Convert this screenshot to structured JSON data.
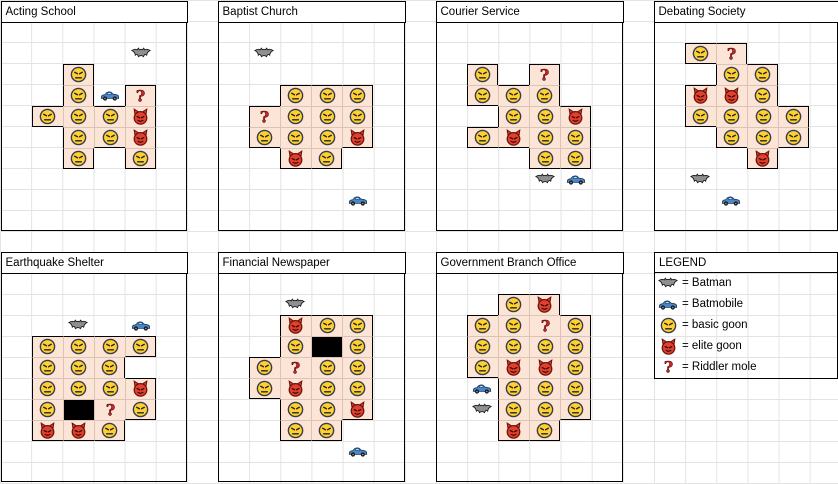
{
  "colors": {
    "shape_fill": "#fce4d6",
    "shape_inner_border": "#d9c4b5",
    "shape_outline": "#000000",
    "black_cell": "#000000",
    "gridline": "#e3e3e3",
    "title_bg": "#ffffff",
    "goon_yellow": "#ffd02e",
    "goon_outline": "#343c50",
    "face_lines": "#1d2430",
    "elite_red": "#e2402e",
    "elite_outline": "#6d1209",
    "riddler_red": "#c5252b",
    "riddler_outline": "#470000",
    "batman_gray": "#8f8f8f",
    "batman_outline": "#1c1c1c",
    "batmobile_blue": "#4a86c8",
    "batmobile_window": "#b8e4f7",
    "batmobile_outline": "#14365c"
  },
  "boards": [
    {
      "title": "Acting School",
      "px": 0,
      "py": 0,
      "cells": [
        [
          2,
          3,
          "basic"
        ],
        [
          2,
          4,
          "basic"
        ],
        [
          4,
          4,
          "riddler"
        ],
        [
          1,
          5,
          "basic"
        ],
        [
          2,
          5,
          "basic"
        ],
        [
          3,
          5,
          "basic"
        ],
        [
          4,
          5,
          "elite"
        ],
        [
          2,
          6,
          "basic"
        ],
        [
          3,
          6,
          "basic"
        ],
        [
          4,
          6,
          "elite"
        ],
        [
          2,
          7,
          "basic"
        ],
        [
          4,
          7,
          "basic"
        ]
      ],
      "icons": [
        [
          4,
          2,
          "batman"
        ],
        [
          3,
          4,
          "batmobile"
        ]
      ]
    },
    {
      "title": "Baptist Church",
      "px": 1,
      "py": 0,
      "cells": [
        [
          2,
          4,
          "basic"
        ],
        [
          3,
          4,
          "basic"
        ],
        [
          4,
          4,
          "basic"
        ],
        [
          1,
          5,
          "riddler"
        ],
        [
          2,
          5,
          "basic"
        ],
        [
          3,
          5,
          "basic"
        ],
        [
          4,
          5,
          "basic"
        ],
        [
          1,
          6,
          "basic"
        ],
        [
          2,
          6,
          "basic"
        ],
        [
          3,
          6,
          "basic"
        ],
        [
          4,
          6,
          "elite"
        ],
        [
          2,
          7,
          "elite"
        ],
        [
          3,
          7,
          "basic"
        ]
      ],
      "icons": [
        [
          1,
          2,
          "batman"
        ],
        [
          4,
          9,
          "batmobile"
        ]
      ]
    },
    {
      "title": "Courier Service",
      "px": 2,
      "py": 0,
      "cells": [
        [
          1,
          3,
          "basic"
        ],
        [
          3,
          3,
          "riddler"
        ],
        [
          1,
          4,
          "basic"
        ],
        [
          2,
          4,
          "basic"
        ],
        [
          3,
          4,
          "basic"
        ],
        [
          2,
          5,
          "basic"
        ],
        [
          3,
          5,
          "basic"
        ],
        [
          4,
          5,
          "elite"
        ],
        [
          1,
          6,
          "basic"
        ],
        [
          2,
          6,
          "elite"
        ],
        [
          3,
          6,
          "basic"
        ],
        [
          4,
          6,
          "basic"
        ],
        [
          3,
          7,
          "basic"
        ],
        [
          4,
          7,
          "basic"
        ]
      ],
      "icons": [
        [
          3,
          8,
          "batman"
        ],
        [
          4,
          8,
          "batmobile"
        ]
      ]
    },
    {
      "title": "Debating Society",
      "px": 3,
      "py": 0,
      "cells": [
        [
          1,
          2,
          "basic"
        ],
        [
          2,
          2,
          "riddler"
        ],
        [
          2,
          3,
          "basic"
        ],
        [
          3,
          3,
          "basic"
        ],
        [
          1,
          4,
          "elite"
        ],
        [
          2,
          4,
          "elite"
        ],
        [
          3,
          4,
          "basic"
        ],
        [
          1,
          5,
          "basic"
        ],
        [
          2,
          5,
          "basic"
        ],
        [
          3,
          5,
          "basic"
        ],
        [
          4,
          5,
          "basic"
        ],
        [
          2,
          6,
          "basic"
        ],
        [
          3,
          6,
          "basic"
        ],
        [
          4,
          6,
          "basic"
        ],
        [
          3,
          7,
          "elite"
        ]
      ],
      "icons": [
        [
          1,
          8,
          "batman"
        ],
        [
          2,
          9,
          "batmobile"
        ]
      ]
    },
    {
      "title": "Earthquake Shelter",
      "px": 0,
      "py": 1,
      "cells": [
        [
          1,
          4,
          "basic"
        ],
        [
          2,
          4,
          "basic"
        ],
        [
          3,
          4,
          "basic"
        ],
        [
          4,
          4,
          "basic"
        ],
        [
          1,
          5,
          "basic"
        ],
        [
          2,
          5,
          "basic"
        ],
        [
          3,
          5,
          "basic"
        ],
        [
          1,
          6,
          "basic"
        ],
        [
          2,
          6,
          "basic"
        ],
        [
          3,
          6,
          "basic"
        ],
        [
          4,
          6,
          "elite"
        ],
        [
          1,
          7,
          "basic"
        ],
        [
          2,
          7,
          "black"
        ],
        [
          3,
          7,
          "riddler"
        ],
        [
          4,
          7,
          "basic"
        ],
        [
          1,
          8,
          "elite"
        ],
        [
          2,
          8,
          "elite"
        ],
        [
          3,
          8,
          "basic"
        ]
      ],
      "icons": [
        [
          2,
          3,
          "batman"
        ],
        [
          4,
          3,
          "batmobile"
        ]
      ]
    },
    {
      "title": "Financial Newspaper",
      "px": 1,
      "py": 1,
      "cells": [
        [
          2,
          3,
          "elite"
        ],
        [
          3,
          3,
          "basic"
        ],
        [
          4,
          3,
          "basic"
        ],
        [
          2,
          4,
          "basic"
        ],
        [
          3,
          4,
          "black"
        ],
        [
          4,
          4,
          "basic"
        ],
        [
          1,
          5,
          "basic"
        ],
        [
          2,
          5,
          "riddler"
        ],
        [
          3,
          5,
          "basic"
        ],
        [
          4,
          5,
          "basic"
        ],
        [
          1,
          6,
          "basic"
        ],
        [
          2,
          6,
          "elite"
        ],
        [
          3,
          6,
          "basic"
        ],
        [
          4,
          6,
          "basic"
        ],
        [
          2,
          7,
          "basic"
        ],
        [
          3,
          7,
          "basic"
        ],
        [
          4,
          7,
          "elite"
        ],
        [
          2,
          8,
          "basic"
        ],
        [
          3,
          8,
          "basic"
        ]
      ],
      "icons": [
        [
          2,
          2,
          "batman"
        ],
        [
          4,
          9,
          "batmobile"
        ]
      ]
    },
    {
      "title": "Government Branch Office",
      "px": 2,
      "py": 1,
      "cells": [
        [
          2,
          2,
          "basic"
        ],
        [
          3,
          2,
          "elite"
        ],
        [
          1,
          3,
          "basic"
        ],
        [
          2,
          3,
          "basic"
        ],
        [
          3,
          3,
          "riddler"
        ],
        [
          4,
          3,
          "basic"
        ],
        [
          1,
          4,
          "basic"
        ],
        [
          2,
          4,
          "basic"
        ],
        [
          3,
          4,
          "basic"
        ],
        [
          4,
          4,
          "basic"
        ],
        [
          1,
          5,
          "basic"
        ],
        [
          2,
          5,
          "elite"
        ],
        [
          3,
          5,
          "elite"
        ],
        [
          4,
          5,
          "basic"
        ],
        [
          2,
          6,
          "basic"
        ],
        [
          3,
          6,
          "basic"
        ],
        [
          4,
          6,
          "basic"
        ],
        [
          2,
          7,
          "basic"
        ],
        [
          3,
          7,
          "basic"
        ],
        [
          4,
          7,
          "basic"
        ],
        [
          2,
          8,
          "elite"
        ],
        [
          3,
          8,
          "basic"
        ]
      ],
      "icons": [
        [
          1,
          6,
          "batmobile"
        ],
        [
          1,
          7,
          "batman"
        ]
      ]
    }
  ],
  "legend": {
    "title": "LEGEND",
    "items": [
      {
        "icon": "batman",
        "label": "= Batman"
      },
      {
        "icon": "batmobile",
        "label": "= Batmobile"
      },
      {
        "icon": "basic",
        "label": "= basic goon"
      },
      {
        "icon": "elite",
        "label": "= elite goon"
      },
      {
        "icon": "riddler",
        "label": "= Riddler mole"
      }
    ]
  }
}
